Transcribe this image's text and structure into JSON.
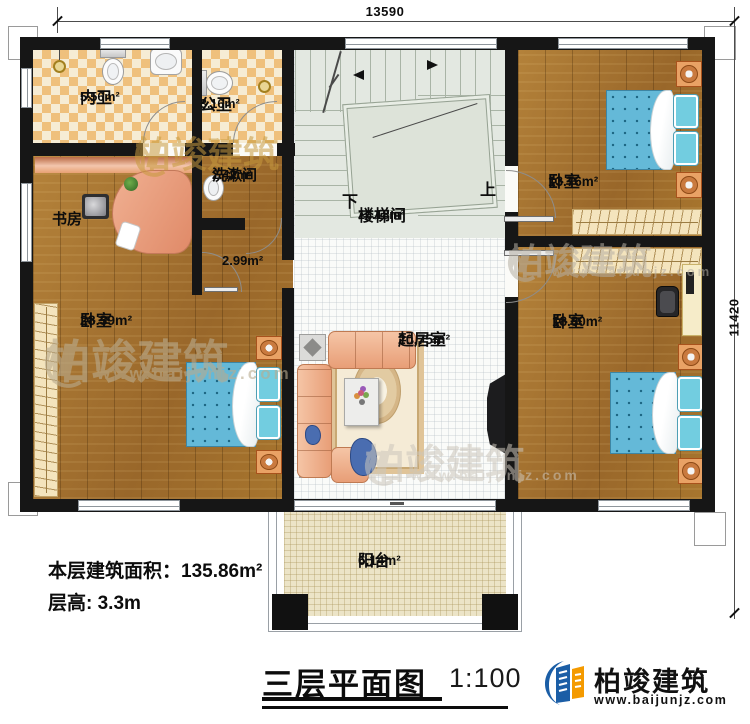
{
  "plan": {
    "title": "三层平面图",
    "scale": "1:100",
    "stats": {
      "area_label": "本层建筑面积：",
      "area_value": "135.86m²",
      "height_label": "层高: ",
      "height_value": "3.3m"
    },
    "dims": {
      "top": "13590",
      "right": "11420"
    },
    "stairs": {
      "down": "下",
      "up": "上"
    }
  },
  "rooms": {
    "neiwei": {
      "name": "内卫",
      "area": "5.56m²"
    },
    "gongwei": {
      "name": "公卫",
      "area": "3.16m²"
    },
    "xishu": {
      "name": "洗漱间",
      "area": "2.42m²"
    },
    "shufang": {
      "name": "书房"
    },
    "hall": {
      "area": "2.99m²"
    },
    "louti": {
      "name": "楼梯间",
      "area": "16.18m²"
    },
    "bed_left": {
      "name": "卧室",
      "area": "28.39m²"
    },
    "bed_tr": {
      "name": "卧室",
      "area": "13.76m²"
    },
    "bed_br": {
      "name": "卧室",
      "area": "18.80m²"
    },
    "qiju": {
      "name": "起居室",
      "area": "20.75m²"
    },
    "yangtai": {
      "name": "阳台",
      "area": "6.14m²"
    }
  },
  "brand": {
    "name": "柏竣建筑",
    "url": "www.baijunjz.com"
  },
  "watermark": {
    "name": "柏竣建筑",
    "url": "www.baijunjz.com"
  },
  "colors": {
    "wall": "#161616",
    "wood": "#a9762f",
    "tile_a": "#f6ecd4",
    "tile_b": "#efc07c",
    "bed": "#64b9d8",
    "stair": "#e3e8e1",
    "balcony": "#ece4c7",
    "brand_blue": "#1b5ea6",
    "brand_orange": "#f49a00"
  }
}
